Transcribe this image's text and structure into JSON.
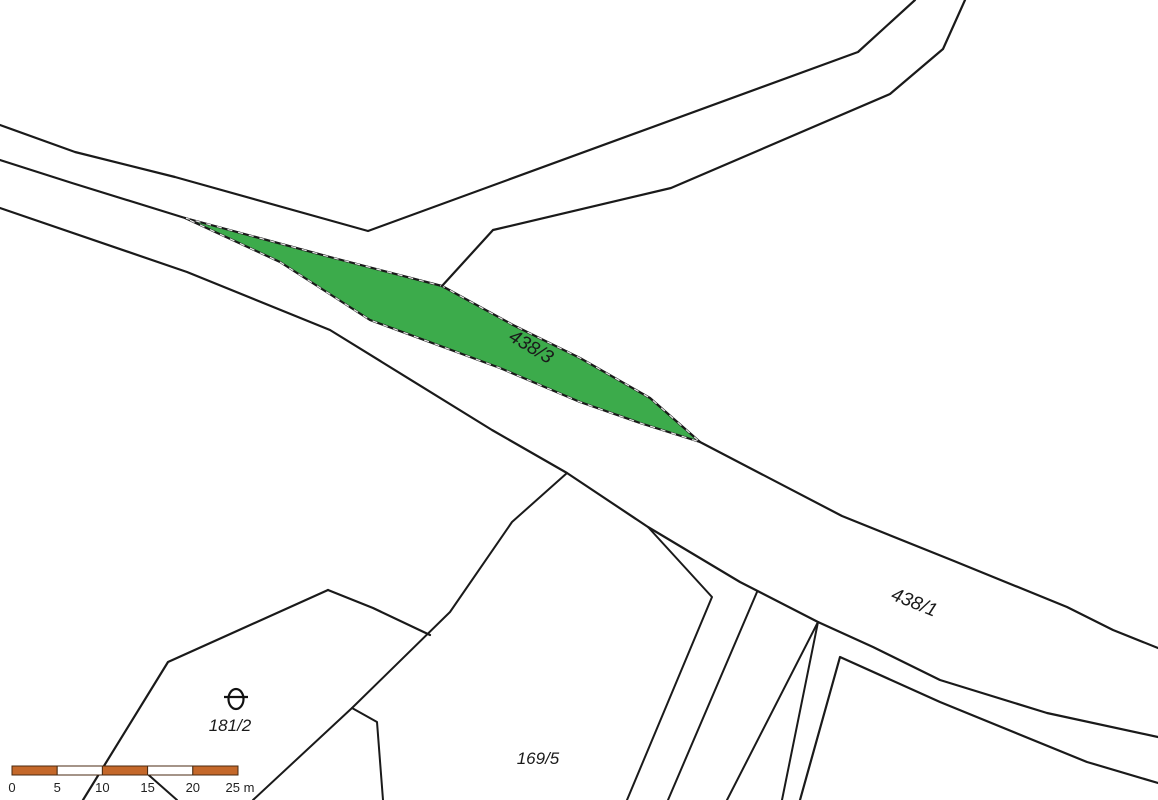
{
  "colors": {
    "background": "#ffffff",
    "boundary_line": "#1a1a1a",
    "highlight_fill": "#3cab4b",
    "highlight_label": "#203a24",
    "neighbor_label": "#5a5a5a",
    "scalebar_fill": "#c4682a",
    "scalebar_alt": "#ffffff"
  },
  "geometry": {
    "north_boundary": "0,125 75,152 175,177 368,231 858,52 915,0",
    "road_upper_left_edge": "0,160 72,183 185,218",
    "green_parcel_outline": "185,218 330,257 442,286 513,325 580,358 650,398 700,442 640,423 580,402 500,368 370,320 280,262",
    "branch_road_right_edge": "442,286 493,230 671,188 890,94 943,49 965,0",
    "road_lower_edge": "0,208 187,272 330,330 492,430 567,473 648,527 740,582 818,622 873,647 940,680 1047,713 1158,737",
    "road_upper_right_edge": "700,442 842,516 954,561 1067,607 1113,630 1158,648",
    "boundary_f1": "567,473 512,522 450,612 352,708 253,800",
    "boundary_notch": "352,708 377,722 383,800",
    "boundary_f2": "648,527 712,597 627,800",
    "boundary_f3": "757,592 668,800",
    "boundary_wedge_left": "818,622 727,800",
    "boundary_wedge_right": "818,622 782,800",
    "south_band_edge": "800,800 840,657 940,702 1087,762 1158,783",
    "parcel_181_upper_left": "83,800 168,662 328,590",
    "parcel_181_right_edge": "328,590 373,608 430,635",
    "boundary_stray": "143,770 177,800"
  },
  "parcels": [
    {
      "id": "438/3",
      "highlighted": true
    },
    {
      "id": "438/1",
      "highlighted": false
    },
    {
      "id": "181/2",
      "highlighted": false
    },
    {
      "id": "169/5",
      "highlighted": false
    }
  ],
  "land_use_symbol": {
    "name": "theta-orchard-symbol"
  },
  "scale_bar": {
    "labels": [
      "0",
      "5",
      "10",
      "15",
      "20",
      "25 m"
    ],
    "segment_meters": 5,
    "total_meters": 25
  }
}
